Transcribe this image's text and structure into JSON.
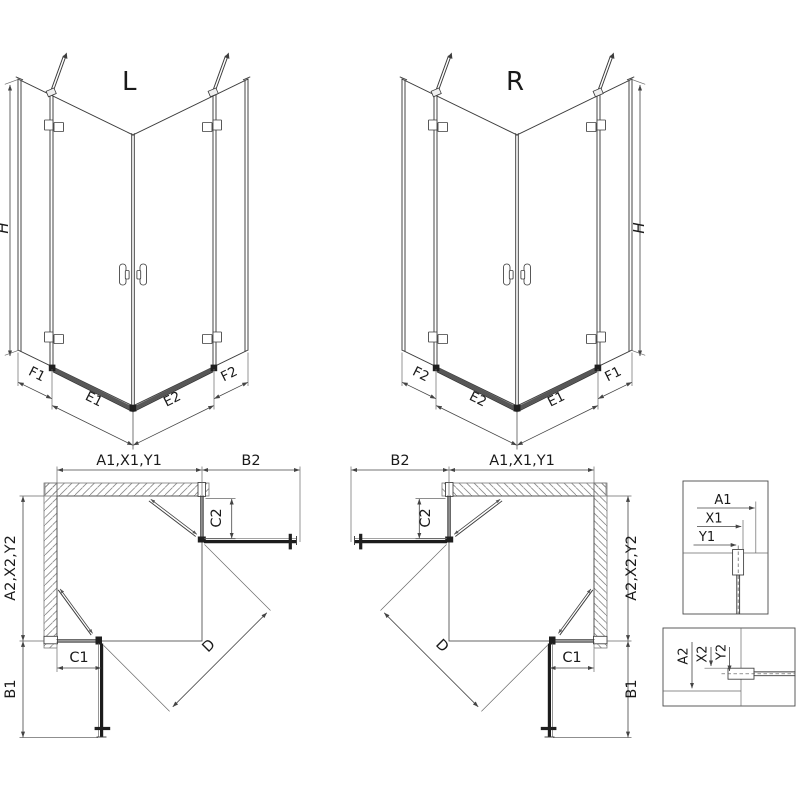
{
  "views": {
    "iso_left": {
      "title": "L"
    },
    "iso_right": {
      "title": "R"
    },
    "dims": {
      "H": "H",
      "F1": "F1",
      "E1": "E1",
      "E2": "E2",
      "F2": "F2"
    },
    "plan_dims": {
      "width_total": "A1,X1,Y1",
      "depth_total": "A2,X2,Y2",
      "door_ext_top": "B2",
      "door_ext_side": "B1",
      "fixed_c1": "C1",
      "fixed_c2": "C2",
      "diagonal": "D"
    },
    "detail_top": {
      "a1": "A1",
      "x1": "X1",
      "y1": "Y1"
    },
    "detail_bottom": {
      "a2": "A2",
      "x2": "X2",
      "y2": "Y2"
    }
  },
  "colors": {
    "line": "#3c3c3c",
    "door_open": "#1f1f1f",
    "hatch": "#8a8a8a",
    "threshold": "#575757",
    "background": "#ffffff"
  }
}
